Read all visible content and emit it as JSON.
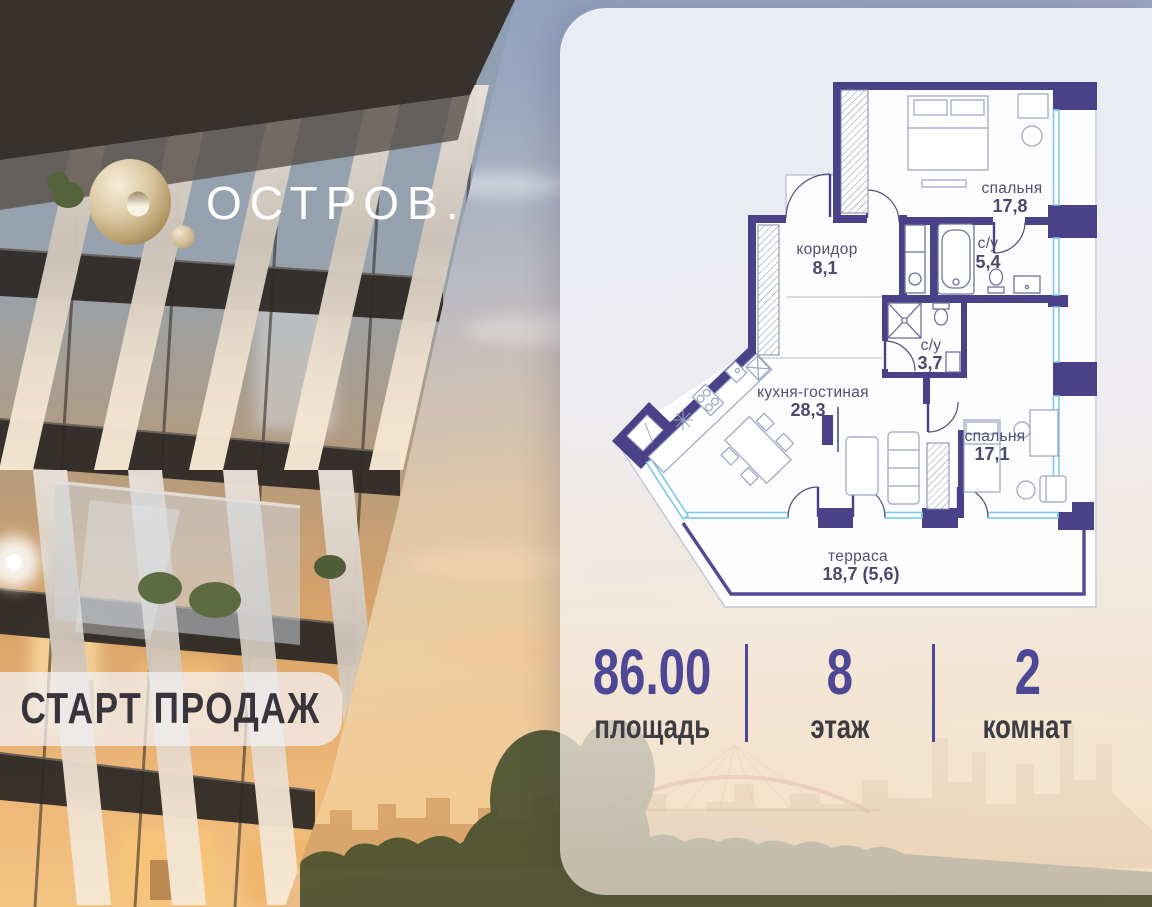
{
  "logo": {
    "brand": "ОСТРОВ."
  },
  "badge": {
    "label": "СТАРТ ПРОДАЖ"
  },
  "floor_plan": {
    "rooms": [
      {
        "name": "спальня",
        "area": "17,8"
      },
      {
        "name": "с/у",
        "area": "5,4"
      },
      {
        "name": "коридор",
        "area": "8,1"
      },
      {
        "name": "с/у",
        "area": "3,7"
      },
      {
        "name": "кухня-гостиная",
        "area": "28,3"
      },
      {
        "name": "спальня",
        "area": "17,1"
      },
      {
        "name": "терраса",
        "area": "18,7 (5,6)"
      }
    ]
  },
  "stats": {
    "area": {
      "value": "86.00",
      "label": "площадь"
    },
    "floor": {
      "value": "8",
      "label": "этаж"
    },
    "rooms": {
      "value": "2",
      "label": "комнат"
    }
  },
  "colors": {
    "accent_purple": "#4e4796",
    "plan_wall": "#4b4189",
    "window_glass": "#7bc9e5",
    "logo_gold": "#d8c5a0"
  }
}
